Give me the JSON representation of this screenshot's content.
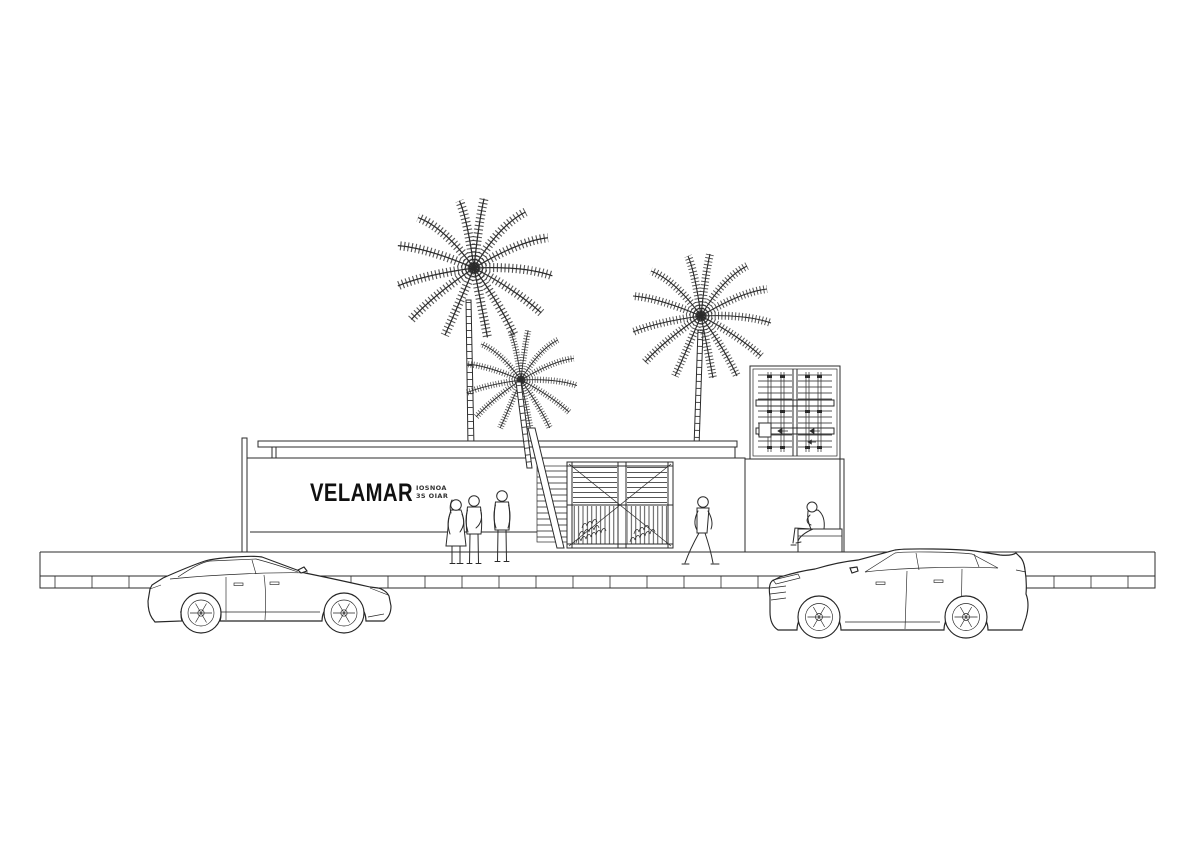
{
  "page": {
    "background": "#ffffff",
    "ink": "#2b2b2b",
    "width": 1200,
    "height": 842
  },
  "sign": {
    "primary": "VELAMAR",
    "secondary_line1": "IOSNOA",
    "secondary_line2": "3S OIAR"
  },
  "scene": {
    "type": "architectural-street-elevation",
    "elements": [
      "palm-tree-tall-left",
      "palm-tree-short-left",
      "palm-tree-right",
      "flat-roof-canopy",
      "signage-wall",
      "open-stair",
      "double-entry-gate",
      "shipping-container",
      "side-wall",
      "bench",
      "pedestrian-couple",
      "pedestrian-standing",
      "pedestrian-walking",
      "pedestrian-seated",
      "sedan-car-facing-right",
      "suv-car-facing-left",
      "sidewalk-with-joints"
    ]
  }
}
